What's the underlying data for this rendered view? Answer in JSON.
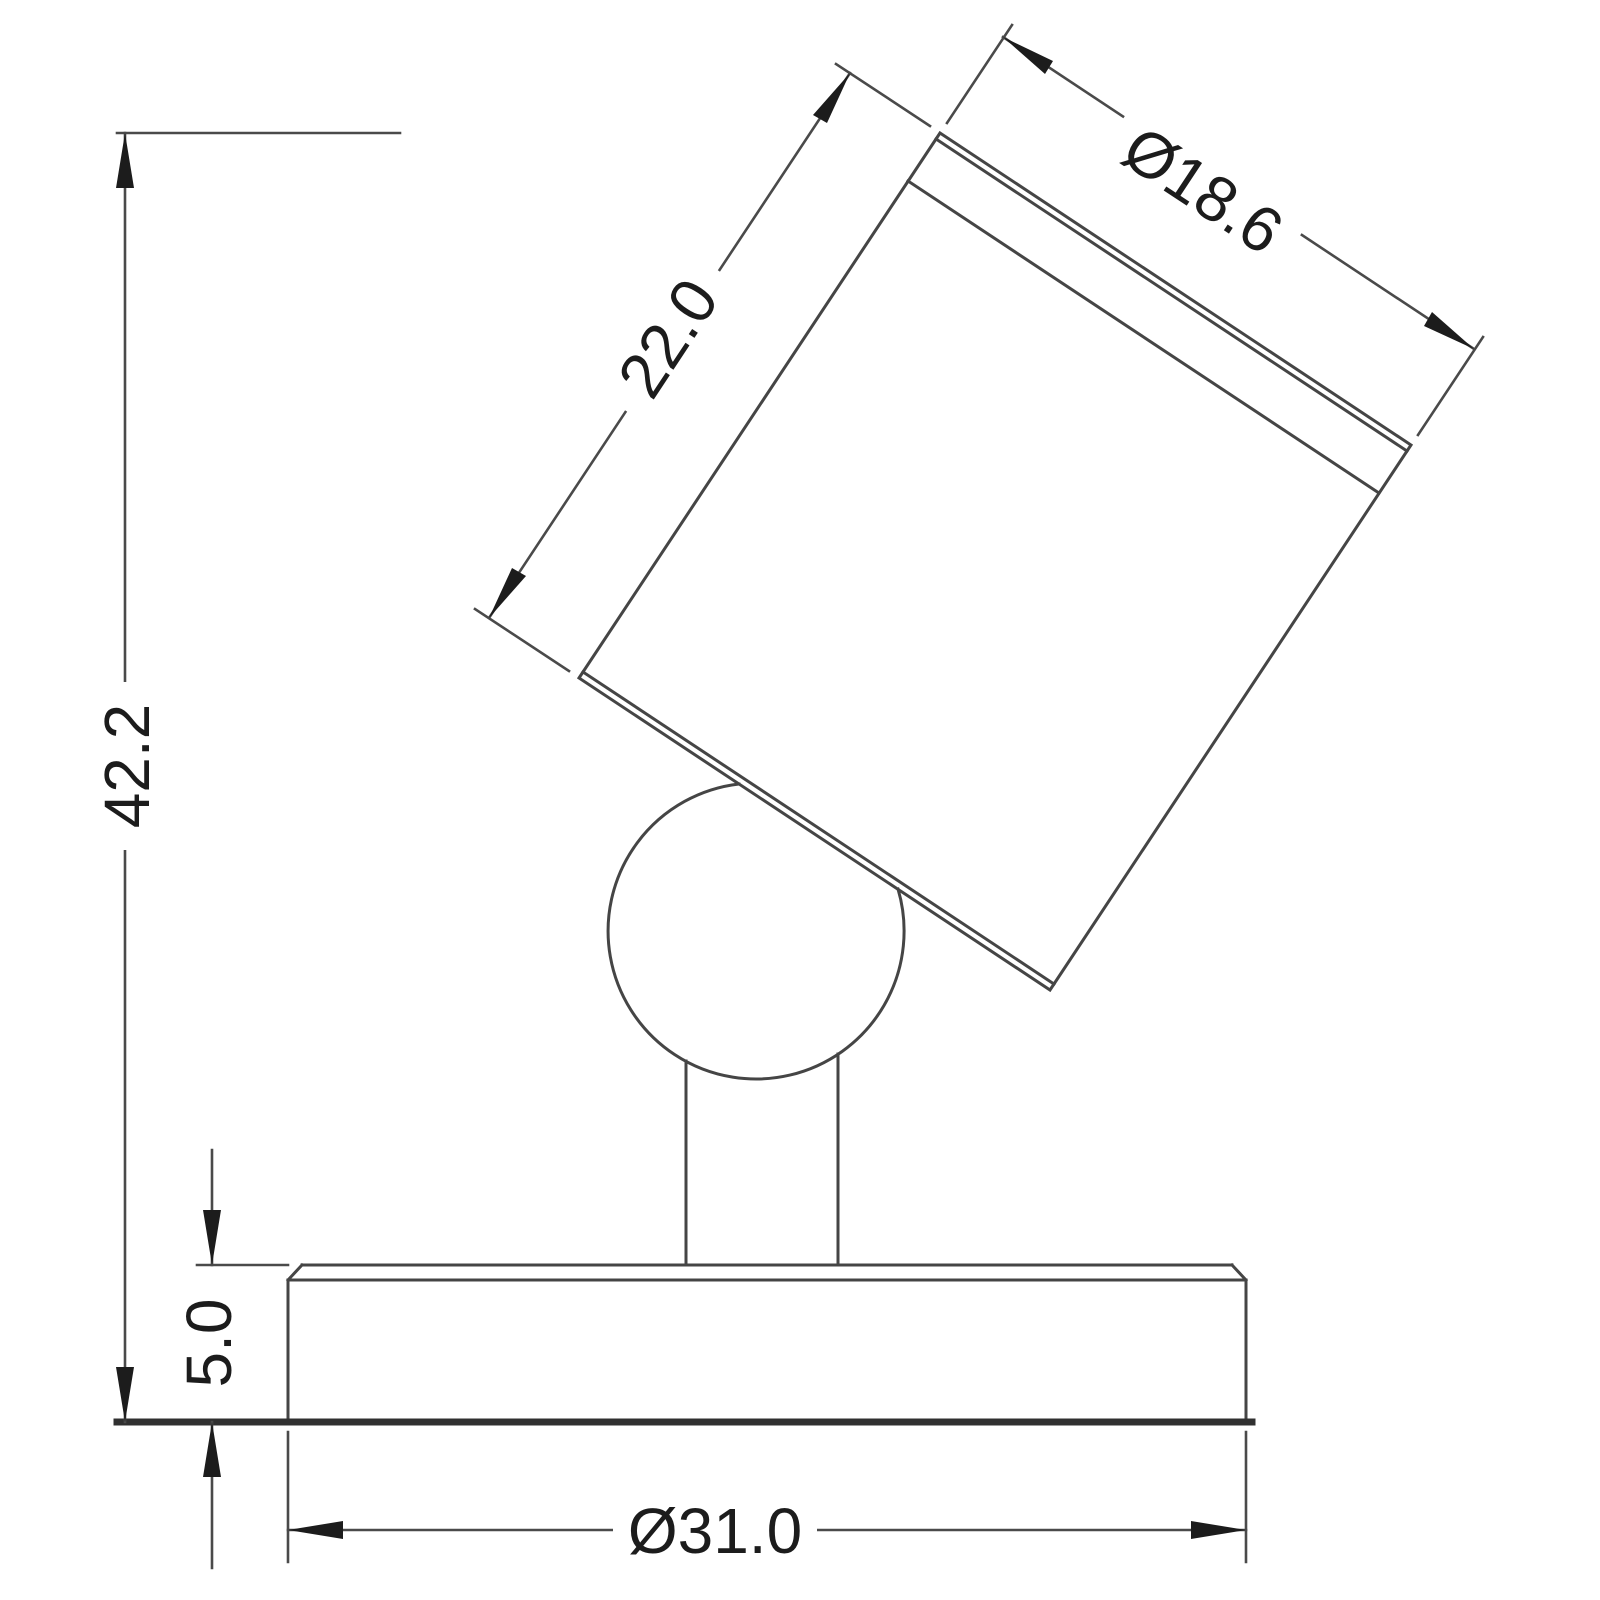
{
  "drawing": {
    "colors": {
      "background": "#ffffff",
      "line": "#454545",
      "thick_line": "#303030",
      "text": "#1c1c1c"
    },
    "dimensions": {
      "total_height": "42.2",
      "base_thickness": "5.0",
      "base_diameter": "Ø31.0",
      "head_length": "22.0",
      "head_face_diameter": "Ø18.6"
    }
  }
}
